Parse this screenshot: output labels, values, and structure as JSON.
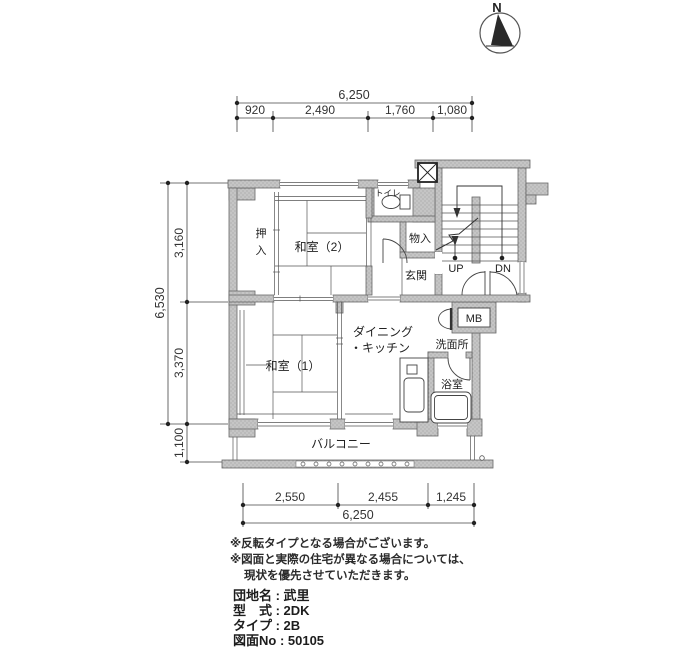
{
  "compass": {
    "label": "N"
  },
  "dims": {
    "top_total": "6,250",
    "top_segments": [
      "920",
      "2,490",
      "1,760",
      "1,080"
    ],
    "left_total": "6,530",
    "left_segments": [
      "3,160",
      "3,370",
      "1,100"
    ],
    "bottom_segments": [
      "2,550",
      "2,455",
      "1,245"
    ],
    "bottom_total": "6,250"
  },
  "rooms": {
    "toilet": "トイレ",
    "oshiire_top": "押",
    "oshiire_bottom": "入",
    "washitsu2": "和室（2）",
    "mononyu": "物入",
    "genkan": "玄関",
    "up": "UP",
    "dn": "DN",
    "mb": "MB",
    "senmenjo": "洗面所",
    "dining_line1": "ダイニング",
    "dining_line2": "・キッチン",
    "washitsu1": "和室（1）",
    "yokushitsu": "浴室",
    "balcony": "バルコニー"
  },
  "notes": [
    "※反転タイプとなる場合がございます。",
    "※図面と実際の住宅が異なる場合については、",
    "現状を優先させていただきます。"
  ],
  "info": {
    "line1": "団地名 : 武里",
    "line2": "型　式 : 2DK",
    "line3": "タイプ : 2B",
    "line4": "図面No : 50105"
  },
  "colors": {
    "wall_fill": "#c5c5c5",
    "wall_dot": "#949494",
    "line": "#333333"
  }
}
